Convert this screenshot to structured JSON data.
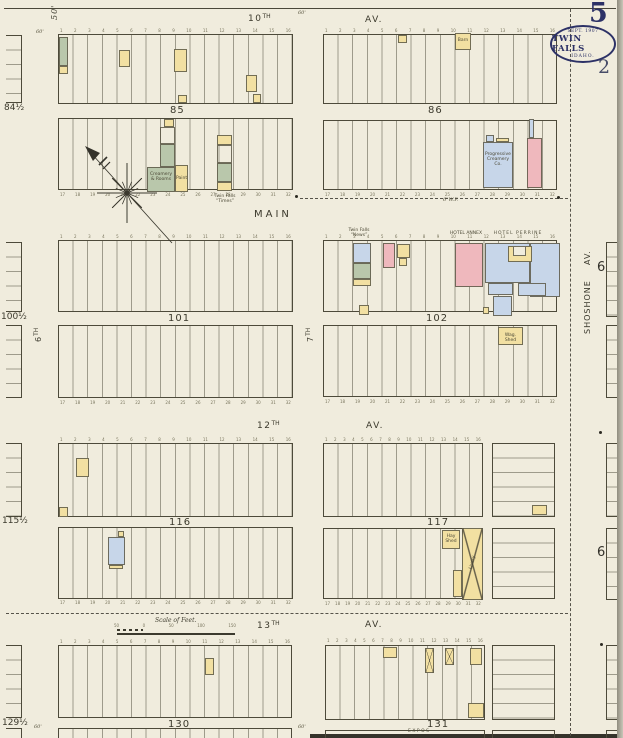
{
  "page": {
    "sheet_number": "5",
    "corner_number": "2",
    "stamp_line1": "SEPT. 1907",
    "stamp_line2": "TWIN FALLS",
    "stamp_line3": "IDAHO."
  },
  "streets": {
    "tenth": "10",
    "tenth_sup": "TH",
    "av_top": "AV.",
    "main": "MAIN",
    "sixth": "6",
    "sixth_sup": "TH",
    "seventh": "7",
    "seventh_sup": "TH",
    "twelfth": "12",
    "twelfth_sup": "TH",
    "av_12": "AV.",
    "thirteenth": "13",
    "thirteenth_sup": "TH",
    "av_13": "AV.",
    "shoshone": "SHOSHONE",
    "shoshone_av": "AV."
  },
  "blocks": {
    "b84h": "84½",
    "b85": "85",
    "b86": "86",
    "b100h": "100½",
    "b101": "101",
    "b102": "102",
    "b115h": "115½",
    "b116": "116",
    "b117": "117",
    "b129h": "129½",
    "b130": "130",
    "b131": "131"
  },
  "refs": {
    "adjacent_sheet": "6"
  },
  "labels": {
    "creamery1": "Creamery",
    "creamery2": "& Rooms",
    "paint": "Paint",
    "times1": "Twin Falls",
    "times2": "“Times”",
    "barn": "Barn",
    "prog1": "Progressive",
    "prog2": "Creamery Co.",
    "news1": "Twin Falls",
    "news2": "“News”",
    "hotel_annex": "HOTEL ANNEX",
    "hotel_perrine": "HOTEL PERRINE",
    "wag_shed": "Wag. Shed",
    "hay_shed1": "Hay",
    "hay_shed2": "Shed",
    "livery": "Livery",
    "expos": "EXPOS-",
    "water_main": "6\"W.P."
  },
  "scale": {
    "title": "Scale of Feet.",
    "ticks": [
      "50",
      "0",
      "50",
      "100",
      "150"
    ]
  },
  "dims": {
    "fifty": "50'",
    "sixty": "60'"
  },
  "lots": {
    "top": [
      "1",
      "2",
      "3",
      "4",
      "5",
      "6",
      "7",
      "8",
      "9",
      "10",
      "11",
      "12",
      "13",
      "14",
      "15",
      "16"
    ],
    "bottom": [
      "17",
      "18",
      "19",
      "20",
      "21",
      "22",
      "23",
      "24",
      "25",
      "26",
      "27",
      "28",
      "29",
      "30",
      "31",
      "32"
    ]
  },
  "colors": {
    "paper": "#f0ecdd",
    "line": "#4d4a3a",
    "frame_yellow": "#f2e0a2",
    "brick_pink": "#efb8bd",
    "stone_blue": "#c7d6e9",
    "special_green": "#b9c7ab",
    "stamp_navy": "#2c3166"
  }
}
